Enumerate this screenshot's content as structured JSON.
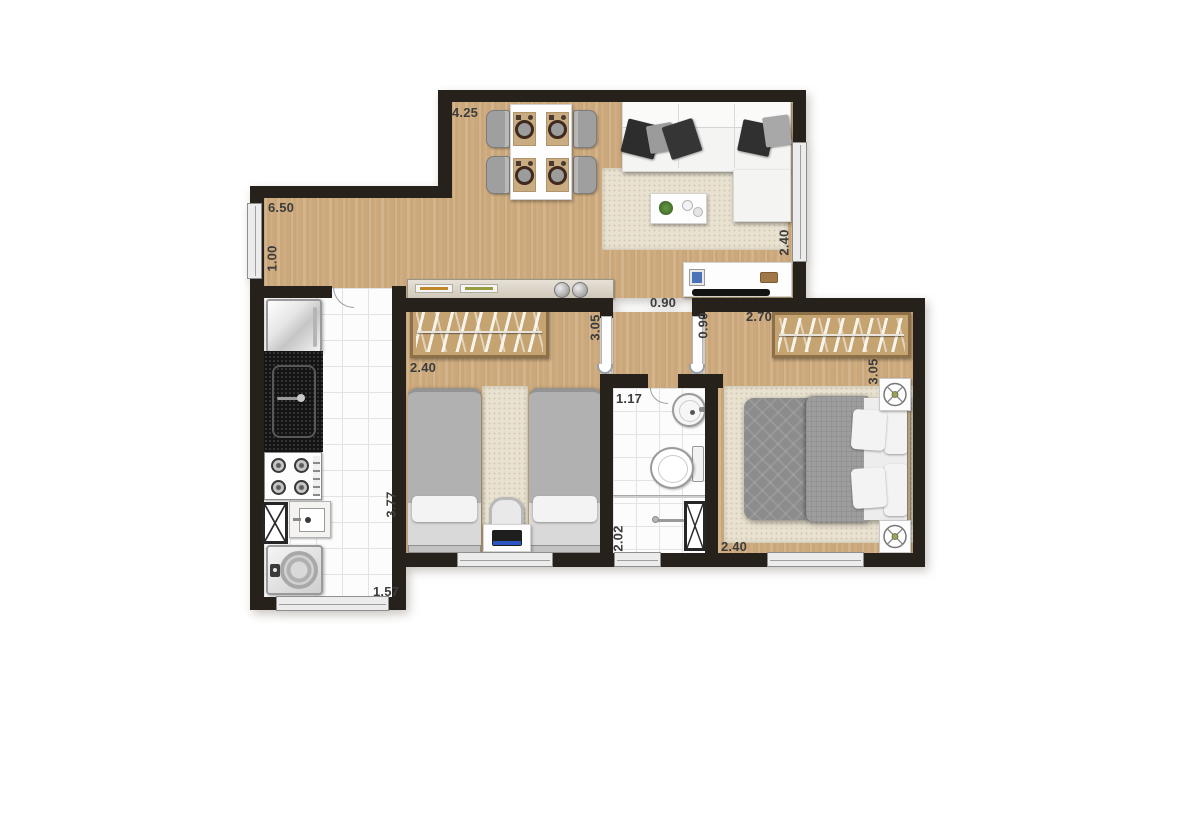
{
  "plan": {
    "dims": {
      "living_top": "4.25",
      "living_left": "6.50",
      "living_left_lower": "1.00",
      "living_right_window": "2.40",
      "hall_opening": "0.90",
      "hall_width": "0.90",
      "bedroom2_width": "2.70",
      "bedroom2_depth": "3.05",
      "bedroom2_window": "2.40",
      "bedroom1_width": "2.40",
      "bedroom1_depth": "3.05",
      "bathroom_width": "1.17",
      "bathroom_depth": "2.02",
      "kitchen_depth": "3.77",
      "kitchen_window": "1.57"
    },
    "colors": {
      "wall": "#27211b",
      "wood": "#cfad80",
      "tile": "#fcfcfc",
      "rug": "#e9e2d1",
      "wardrobe": "#c5a472"
    }
  }
}
